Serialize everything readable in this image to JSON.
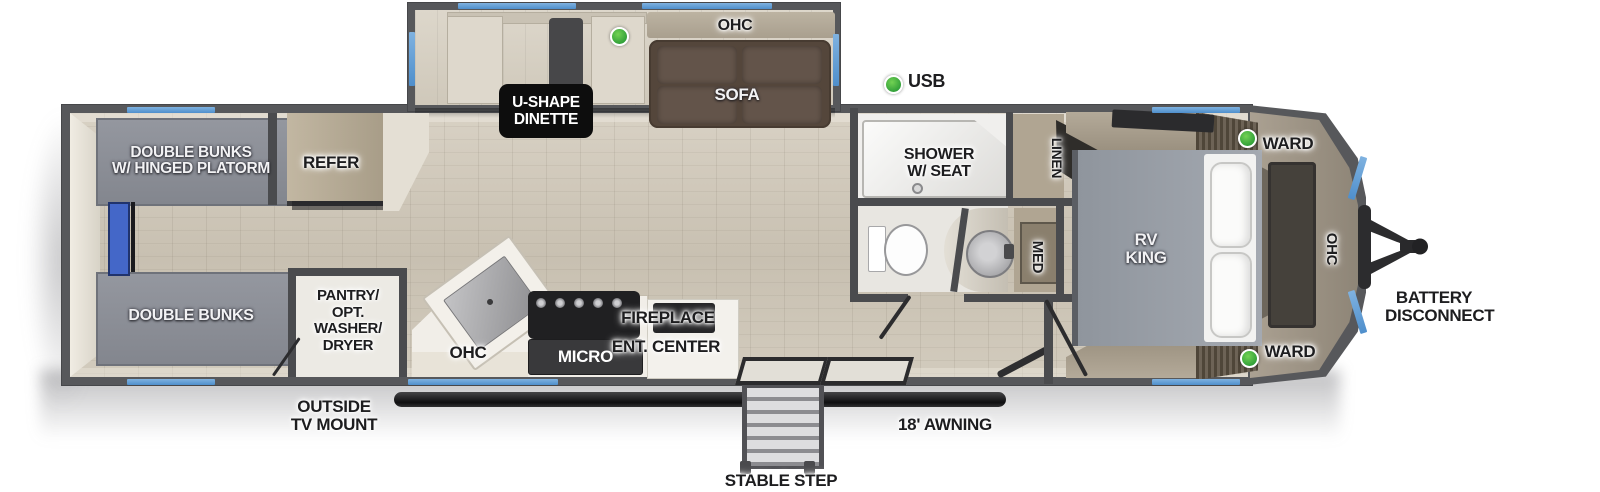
{
  "colors": {
    "window_blue": "#5b9bd5",
    "usb_green": "#3bb54a",
    "wall_gray": "#57585b",
    "floor_tan": "#cfc7b8",
    "sofa_brown": "#54463b"
  },
  "legend": {
    "usb_label": "USB"
  },
  "labels": {
    "ohc": "OHC",
    "sofa": "SOFA",
    "u_shape_dinette": "U-SHAPE\nDINETTE",
    "double_bunks_hinged": "DOUBLE BUNKS\nW/ HINGED PLATORM",
    "refer": "REFER",
    "double_bunks": "DOUBLE BUNKS",
    "pantry_opt_washer_dryer": "PANTRY/\nOPT.\nWASHER/\nDRYER",
    "outside_tv_mount": "OUTSIDE\nTV MOUNT",
    "micro": "MICRO",
    "fireplace": "FIREPLACE",
    "ent_center": "ENT. CENTER",
    "shower_w_seat": "SHOWER\nW/ SEAT",
    "linen": "LINEN",
    "med": "MED",
    "rv_king": "RV\nKING",
    "ward": "WARD",
    "battery_disconnect": "BATTERY\nDISCONNECT",
    "awning_18": "18' AWNING",
    "stable_step": "STABLE STEP"
  }
}
